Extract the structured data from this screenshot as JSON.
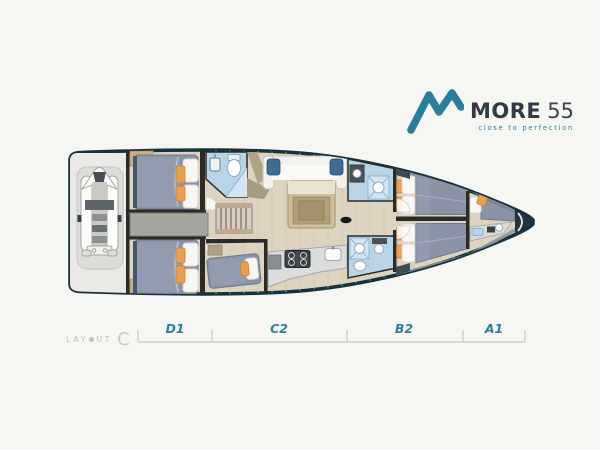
{
  "header": {
    "brand": "MORE",
    "model": "55",
    "tagline": "close to perfection"
  },
  "layout_label": {
    "prefix": "LAY",
    "suffix": "UT",
    "variant": "C"
  },
  "dimension_line": {
    "segments": [
      {
        "label": "D1"
      },
      {
        "label": "C2"
      },
      {
        "label": "B2"
      },
      {
        "label": "A1"
      }
    ]
  },
  "colors": {
    "background": "#f6f6f3",
    "hull_outline": "#16323c",
    "floor_wood": "#ded3bf",
    "accent_teal": "#2a7d9b",
    "brand_text": "#323b45",
    "label_gray": "#c0c0bd",
    "bed_upholstery": "#8b94a7",
    "cushion_orange": "#e9a050",
    "bathroom_blue": "#b7d4e9",
    "dimension_line_gray": "#c9c9c5"
  }
}
